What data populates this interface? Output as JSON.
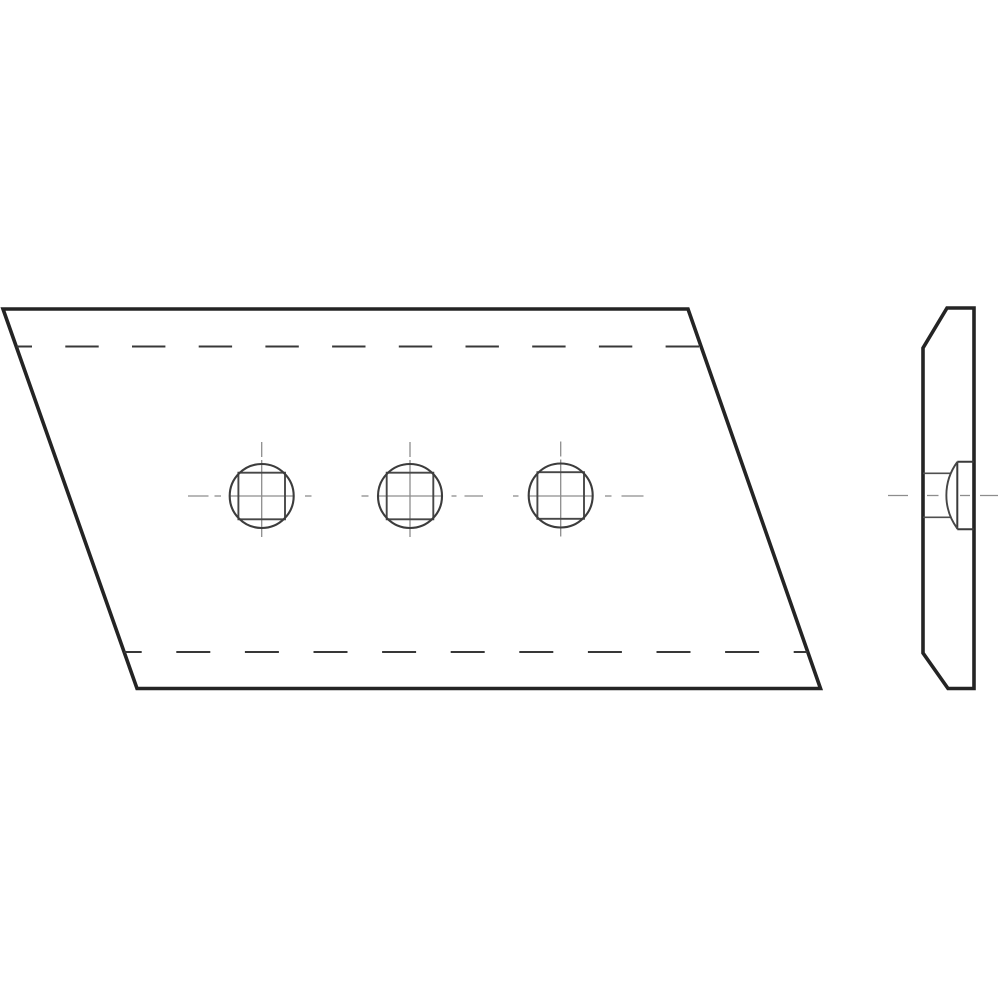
{
  "canvas": {
    "width": 1000,
    "height": 1000,
    "background": "#ffffff"
  },
  "drawing": {
    "description": "Two-view technical line drawing: parallelogram wear plate with three countersunk square bolt holes (front view) and edge profile with countersunk recess (side view)",
    "line_styles": {
      "outline": {
        "color": "#242424",
        "width": 3.6
      },
      "object": {
        "color": "#3c3c3c",
        "width": 2.1
      },
      "square": {
        "color": "#474747",
        "width": 1.9
      },
      "hidden": {
        "color": "#383838",
        "width": 2.1
      },
      "centerline": {
        "color": "#8d8d8d",
        "width": 1.3
      },
      "bore": {
        "color": "#4f4f4f",
        "width": 1.7
      },
      "detail": {
        "color": "#3a3a3a",
        "width": 2.0
      },
      "arc": {
        "color": "#464646",
        "width": 1.9
      }
    },
    "front_view": {
      "outline_points": "3,309 688,309 820.5,688.5 137,688.5",
      "hidden_lines": [
        {
          "x1": 16.5,
          "y1": 346.5,
          "x2": 701,
          "y2": 346.5,
          "dasharray": "33.4 33.3",
          "dashoffset": 17.9
        },
        {
          "x1": 124,
          "y1": 652,
          "x2": 807.5,
          "y2": 652,
          "dasharray": "34 34.6",
          "dashoffset": 16.3
        }
      ],
      "holes": {
        "centers": [
          [
            261.7,
            496
          ],
          [
            410,
            496
          ],
          [
            560.7,
            495.5
          ]
        ],
        "circle_radius": 32,
        "square_half_side": 23.3,
        "vertical_centerline_offsets": [
          [
            -54,
            -39
          ],
          [
            -36,
            41
          ]
        ]
      },
      "horizontal_centerline": {
        "y": 496,
        "segments": [
          [
            188,
            208.5
          ],
          [
            214.5,
            221
          ],
          [
            229.5,
            293.5
          ],
          [
            305,
            311.5
          ],
          [
            361.5,
            368.5
          ],
          [
            378,
            442
          ],
          [
            451.5,
            456.5
          ],
          [
            464.5,
            483
          ],
          [
            513,
            518.5
          ],
          [
            529,
            593
          ],
          [
            605,
            611.5
          ],
          [
            621.5,
            643.5
          ]
        ]
      }
    },
    "side_view": {
      "outline_points": "947,308 974,308 974,688.5 948,688.5 923,653 923,348",
      "recess_lines": [
        [
          957.3,
          461.7,
          974,
          461.7
        ],
        [
          957.3,
          529.3,
          974,
          529.3
        ],
        [
          957.3,
          461.7,
          957.3,
          529.3
        ]
      ],
      "bore_lines": [
        [
          923,
          473.3,
          951,
          473.3
        ],
        [
          923,
          517.3,
          951,
          517.3
        ]
      ],
      "dome_arc": {
        "x": 957.3,
        "y1": 462,
        "y2": 528.5,
        "radius": 56
      },
      "centerline": {
        "y": 495.5,
        "segments": [
          [
            888,
            908
          ],
          [
            927,
            938.5
          ],
          [
            960,
            970
          ],
          [
            980,
            998
          ]
        ]
      }
    }
  }
}
